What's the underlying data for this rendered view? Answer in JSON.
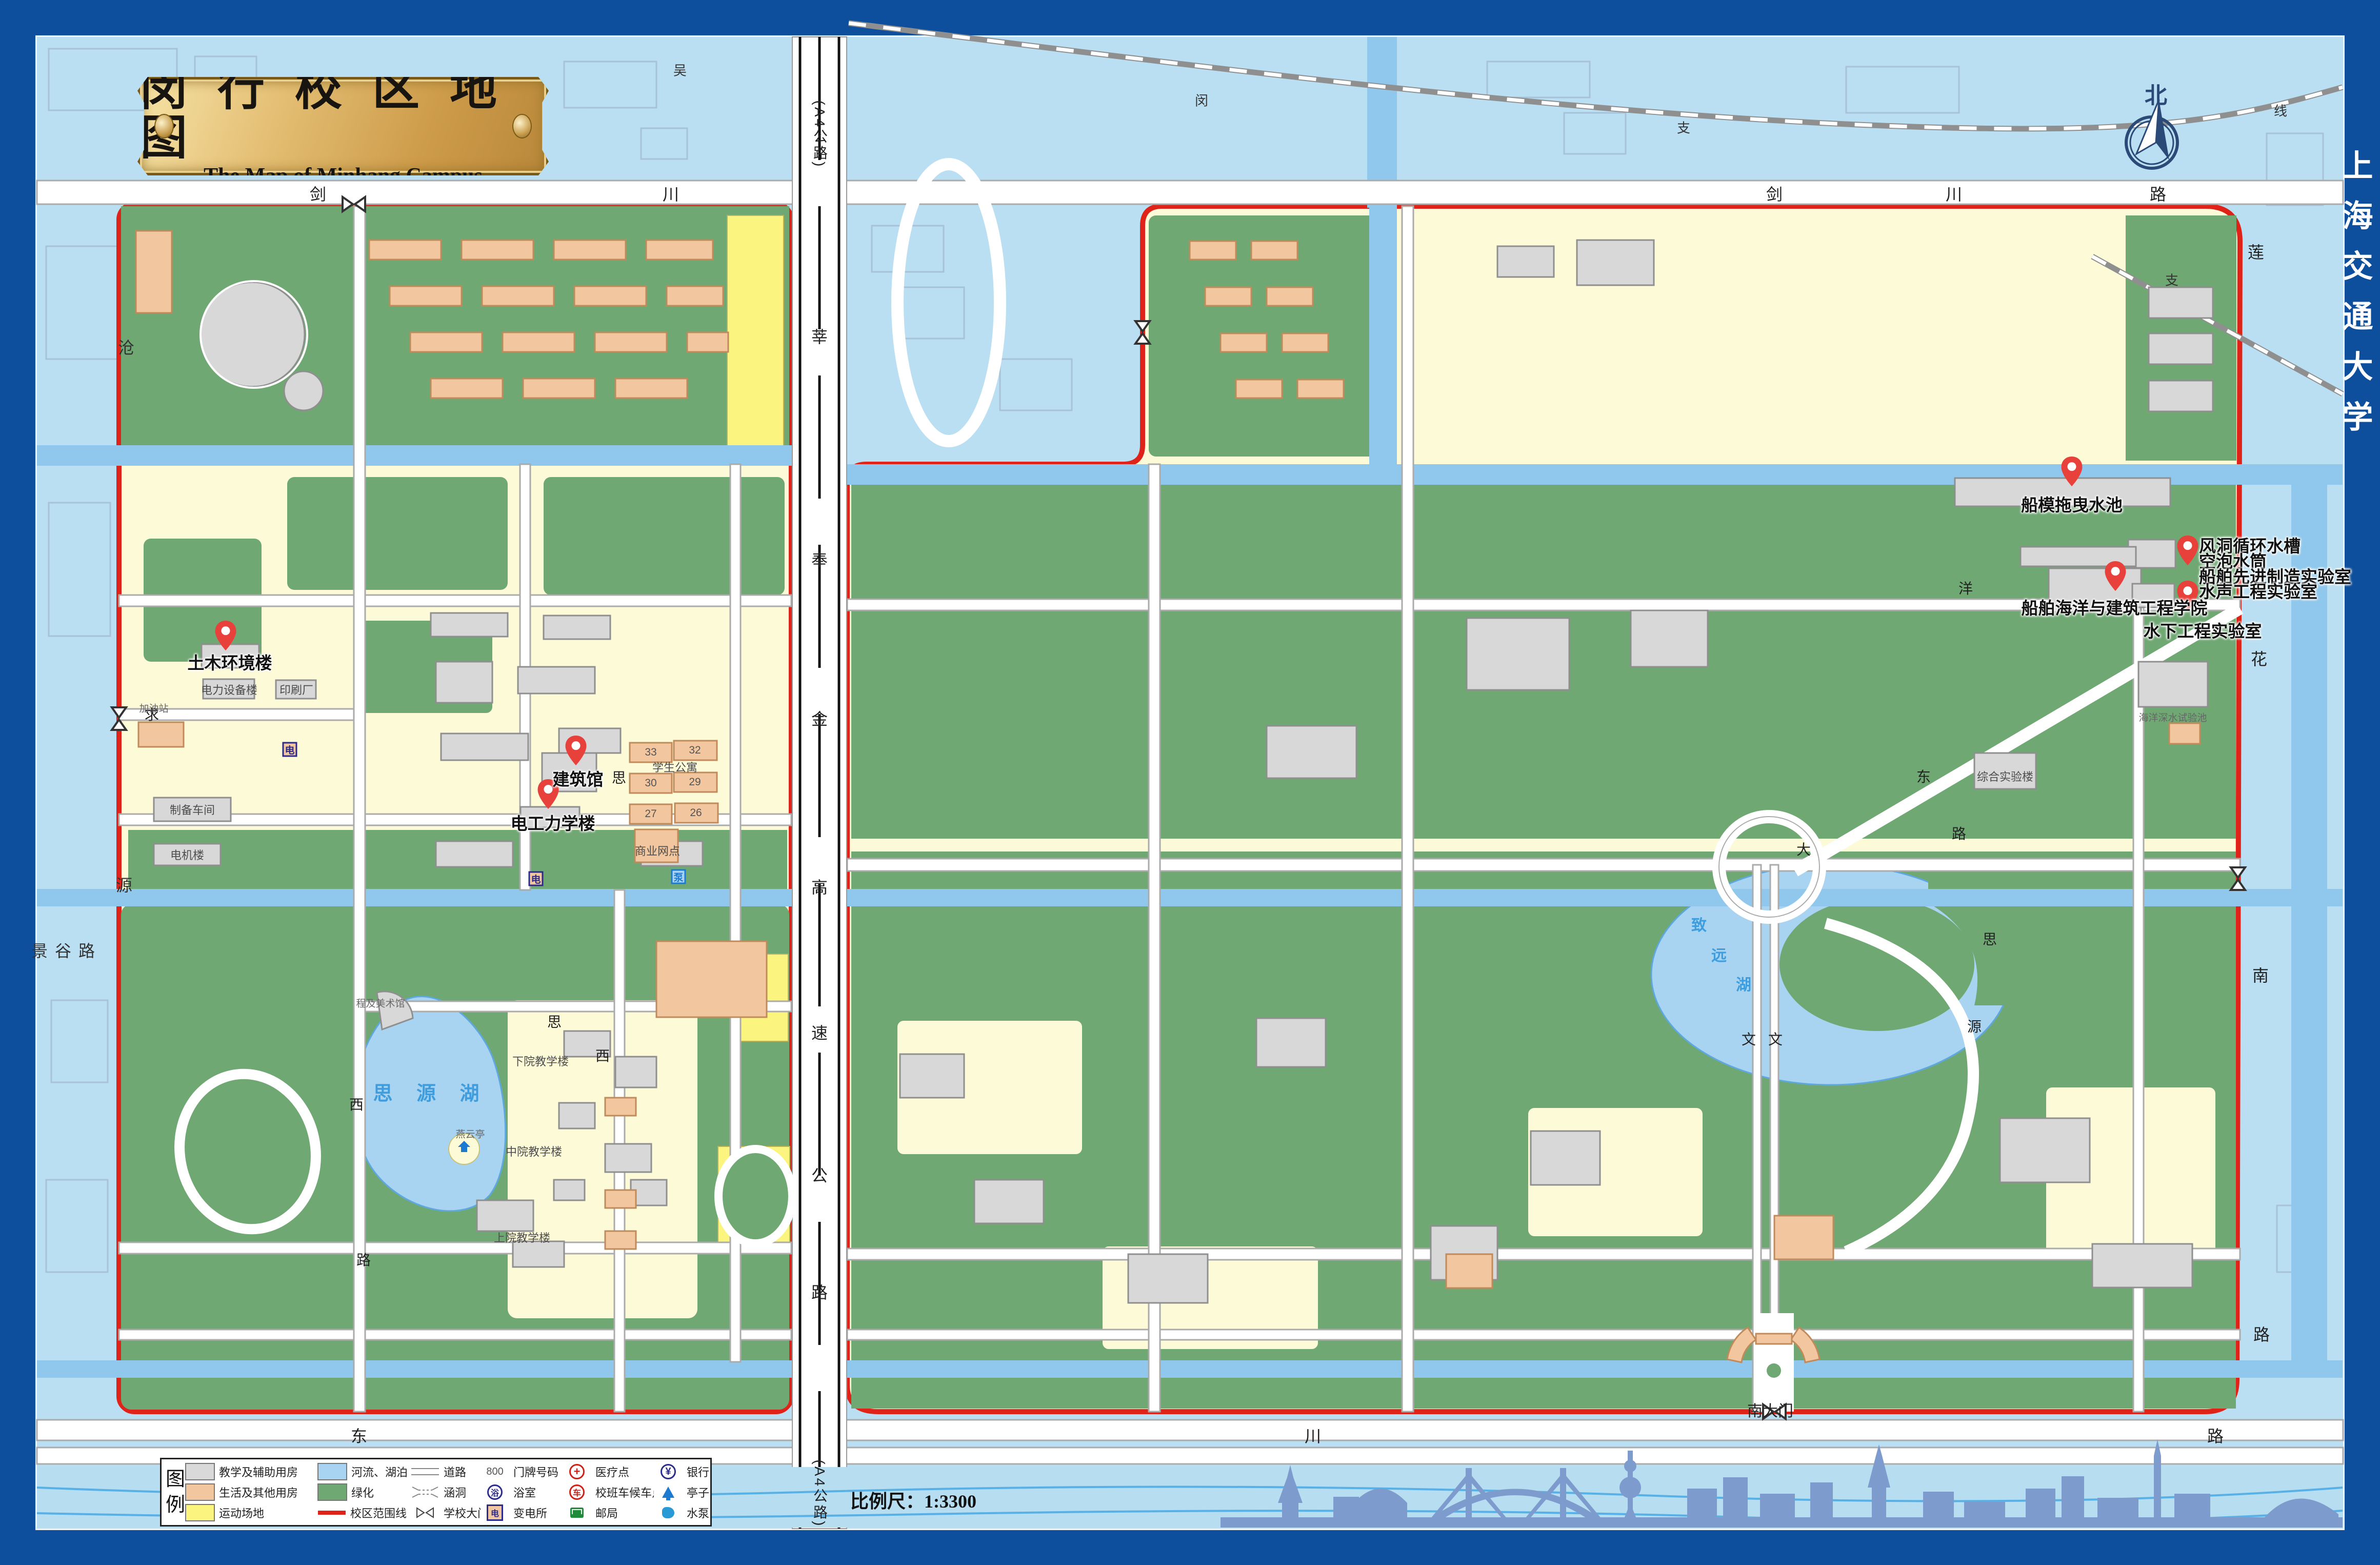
{
  "title": {
    "zh": "闵 行 校 区 地 图",
    "en": "The Map of Minhang Campus"
  },
  "frame": {
    "university": "上海交通大学"
  },
  "compass": {
    "north": "北"
  },
  "scalebar": {
    "label": "比例尺：",
    "value": "1:3300"
  },
  "legend": {
    "heading": [
      "图",
      "例"
    ],
    "items": [
      {
        "icon": "swatch-gray-icon",
        "label": "教学及辅助用房"
      },
      {
        "icon": "swatch-blue-icon",
        "label": "河流、湖泊"
      },
      {
        "icon": "road-lines-icon",
        "label": "道路"
      },
      {
        "icon": "house-number-icon",
        "label": "门牌号码",
        "sample": "800"
      },
      {
        "icon": "medical-cross-icon",
        "label": "医疗点",
        "glyph": "+"
      },
      {
        "icon": "bank-icon",
        "label": "银行",
        "glyph": "¥"
      },
      {
        "icon": "swatch-orange-icon",
        "label": "生活及其他用房"
      },
      {
        "icon": "swatch-green-icon",
        "label": "绿化"
      },
      {
        "icon": "culvert-icon",
        "label": "涵洞"
      },
      {
        "icon": "bath-icon",
        "label": "浴室",
        "glyph": "浴"
      },
      {
        "icon": "shuttle-stop-icon",
        "label": "校班车候车点",
        "glyph": "车"
      },
      {
        "icon": "pavilion-icon",
        "label": "亭子"
      },
      {
        "icon": "swatch-yellow-icon",
        "label": "运动场地"
      },
      {
        "icon": "boundary-line-icon",
        "label": "校区范围线"
      },
      {
        "icon": "school-gate-icon",
        "label": "学校大门"
      },
      {
        "icon": "substation-icon",
        "label": "变电所",
        "glyph": "电"
      },
      {
        "icon": "post-office-icon",
        "label": "邮局"
      },
      {
        "icon": "pump-house-icon",
        "label": "水泵房"
      }
    ]
  },
  "pins": [
    {
      "label": "土木环境楼"
    },
    {
      "label": "建筑馆"
    },
    {
      "label": "电工力学楼"
    },
    {
      "label": "船模拖曳水池"
    },
    {
      "lines": [
        "风洞循环水槽",
        "空泡水筒",
        "船舶先进制造实验室",
        "水声工程实验室"
      ]
    },
    {
      "label": "船舶海洋与建筑工程学院"
    },
    {
      "label": "水下工程实验室"
    }
  ],
  "gates": {
    "south": "南大门"
  },
  "roads": {
    "jianchuan_w": [
      "剑",
      "川"
    ],
    "jianchuan_e": [
      "剑",
      "川",
      "路"
    ],
    "dongchuan": [
      "东",
      "川",
      "路"
    ],
    "expressway": [
      "(A4公路)",
      "莘",
      "奉",
      "金",
      "高",
      "速",
      "公",
      "路",
      "(A4公路)"
    ],
    "cangyuan": [
      "沧",
      "源"
    ],
    "jinggu": "景谷路",
    "lianhua": [
      "莲",
      "花",
      "南",
      "路"
    ],
    "railway": [
      "吴",
      "闵",
      "支",
      "线",
      "支"
    ],
    "campus_w": [
      "思",
      "思",
      "西",
      "西",
      "路",
      "求"
    ],
    "campus_e": [
      "大",
      "东",
      "路",
      "思",
      "源",
      "文",
      "文",
      "洋"
    ]
  },
  "places": {
    "dianli": "电力设备楼",
    "yinshua": "印刷厂",
    "jiayouzhan": "加油站",
    "zhibei": "制备车间",
    "dianji": "电机楼",
    "xuesheng": "学生公寓",
    "shangye": "商业网点",
    "dorm_nums": [
      "33",
      "32",
      "30",
      "29",
      "27",
      "26"
    ],
    "siyuan_lake": "思 源 湖",
    "zhiyuan_lake": [
      "致",
      "远",
      "湖"
    ],
    "yanyunting": "燕云亭",
    "chengji": "程及美术馆",
    "xiayuan": "下院教学楼",
    "zhongyuan": "中院教学楼",
    "shangyuan": "上院教学楼",
    "zonghe": "综合实验楼",
    "haiyang": "海洋深水试验池"
  }
}
